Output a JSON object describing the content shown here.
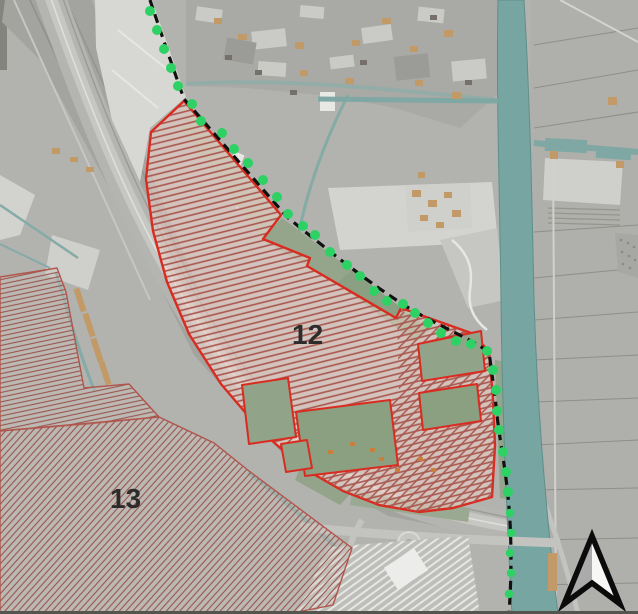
{
  "map": {
    "zone12": {
      "label": "12",
      "border_color": "#da2b20",
      "hatch_color": "#a8574e",
      "fill_color": "rgba(238,210,200,0.55)"
    },
    "zone13": {
      "label": "13",
      "border_color": "#b0564c",
      "hatch_color": "#98564e",
      "fill_color": "rgba(205,195,190,0.35)"
    },
    "boundary": {
      "line_color": "#111111",
      "line_style": "dashed",
      "marker_color": "#2ed164",
      "marker_shape": "circle"
    },
    "water_color": "#76a5a2",
    "north_arrow": {
      "outline_color": "#0b0b0b",
      "left_fill": "#ababab",
      "right_fill": "#f7f7f5"
    }
  }
}
